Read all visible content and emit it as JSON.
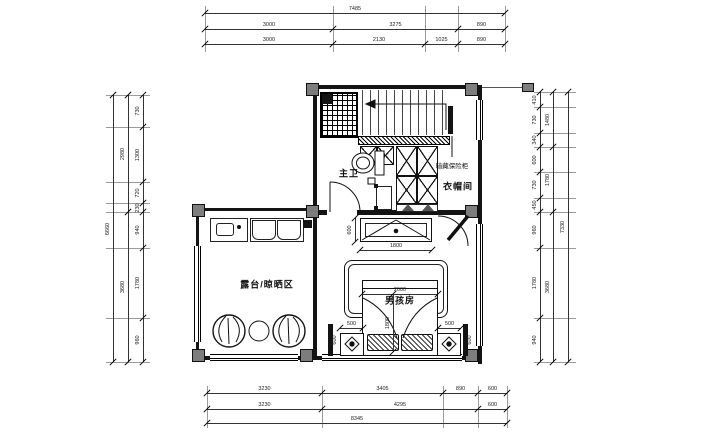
{
  "rooms": {
    "master_bath": "主卫",
    "cloakroom": "衣帽间",
    "boys_room": "男孩房",
    "terrace": "露台/晾晒区"
  },
  "annotations": {
    "hidden_safe": "暗藏保险柜"
  },
  "furniture_dims": {
    "desk_depth": "600",
    "desk_width": "1800",
    "bed_width": "2000",
    "bed_length": "1800",
    "nightstand_left": "500",
    "nightstand_right": "500",
    "side_left": "600",
    "side_right": "600"
  },
  "dims_top": {
    "total": "7485",
    "row2": [
      "3000",
      "3275",
      "890"
    ],
    "row3": [
      "3000",
      "2130",
      "1025",
      "890"
    ]
  },
  "dims_bottom": {
    "row1": [
      "3230",
      "3405",
      "890",
      "600"
    ],
    "row2": [
      "3230",
      "4295",
      "600"
    ],
    "total": "8345"
  },
  "dims_left": {
    "total": "6660",
    "mid": [
      "2980",
      "3680"
    ],
    "inner": [
      "730",
      "1300",
      "720",
      "230",
      "940",
      "1780",
      "960"
    ]
  },
  "dims_right": {
    "inner": [
      "410",
      "730",
      "340",
      "600",
      "730",
      "450",
      "960",
      "1780",
      "940"
    ],
    "mid": [
      "1480",
      "1780",
      "3680"
    ],
    "total": "7330"
  },
  "colors": {
    "line": "#1a1a1a",
    "column_fill": "#7d7d7d",
    "background": "#ffffff"
  }
}
